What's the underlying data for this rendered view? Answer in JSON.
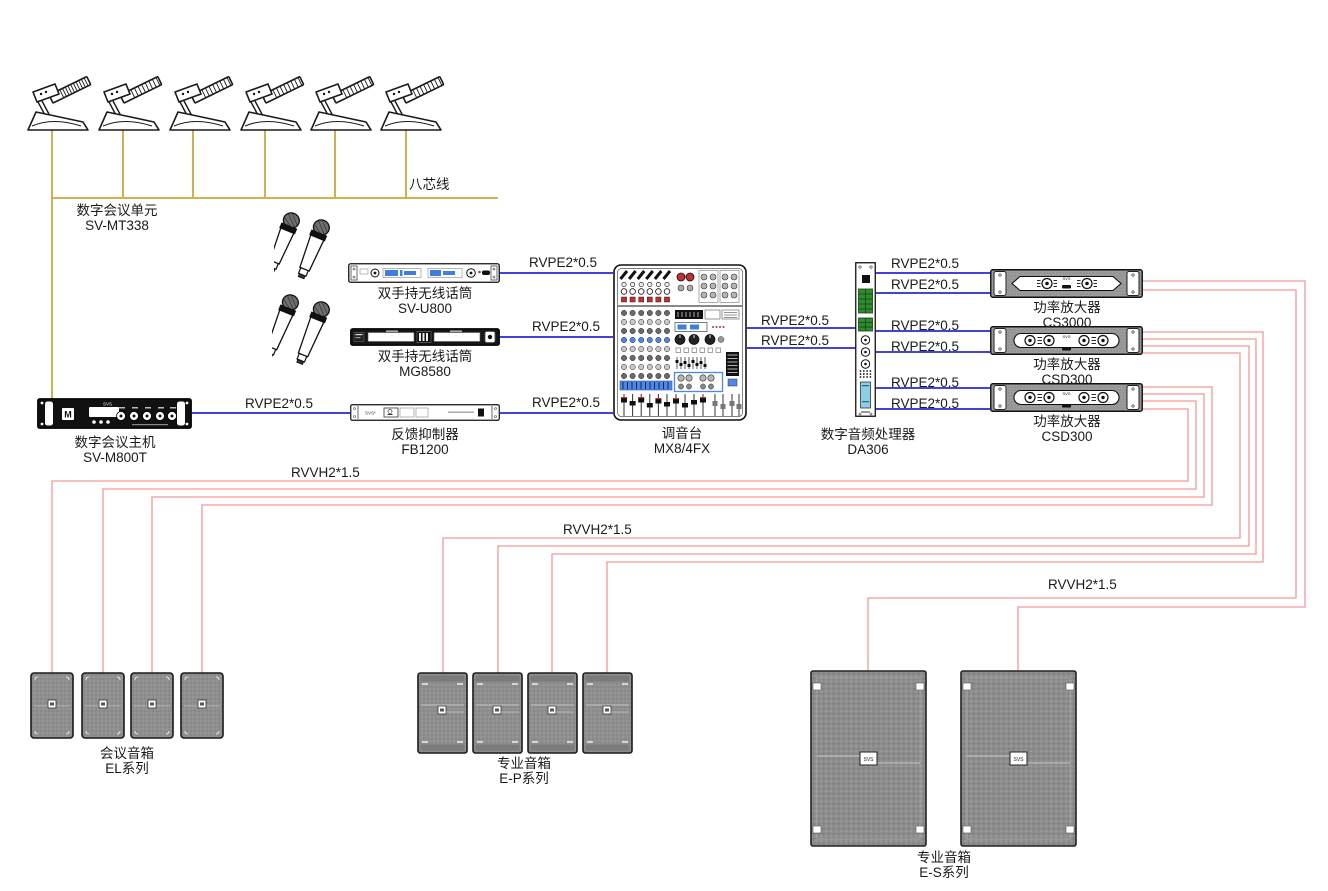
{
  "colors": {
    "wire_signal_blue": "#4343d9",
    "wire_speaker_red": "#f59898",
    "wire_bus_yellow": "#d0b050",
    "device_gray": "#8f8f8f",
    "display_blue": "#4f87e8"
  },
  "cables": {
    "eight_core": "八芯线",
    "signal": "RVPE2*0.5",
    "speaker": "RVVH2*1.5"
  },
  "devices": {
    "conference_mics": {
      "name": "数字会议单元",
      "model": "SV-MT338",
      "count": 6
    },
    "wireless_receiver_1": {
      "name": "双手持无线话筒",
      "model": "SV-U800"
    },
    "wireless_receiver_2": {
      "name": "双手持无线话筒",
      "model": "MG8580"
    },
    "conference_host": {
      "name": "数字会议主机",
      "model": "SV-M800T"
    },
    "feedback_suppressor": {
      "name": "反馈抑制器",
      "model": "FB1200"
    },
    "mixer": {
      "name": "调音台",
      "model": "MX8/4FX"
    },
    "audio_processor": {
      "name": "数字音频处理器",
      "model": "DA306"
    },
    "amplifier_1": {
      "name": "功率放大器",
      "model": "CS3000"
    },
    "amplifier_2": {
      "name": "功率放大器",
      "model": "CSD300"
    },
    "amplifier_3": {
      "name": "功率放大器",
      "model": "CSD300"
    },
    "conference_speakers": {
      "name": "会议音箱",
      "model": "EL系列",
      "count": 4
    },
    "pro_speakers_p": {
      "name": "专业音箱",
      "model": "E-P系列",
      "count": 4
    },
    "pro_speakers_s": {
      "name": "专业音箱",
      "model": "E-S系列",
      "count": 2
    }
  }
}
